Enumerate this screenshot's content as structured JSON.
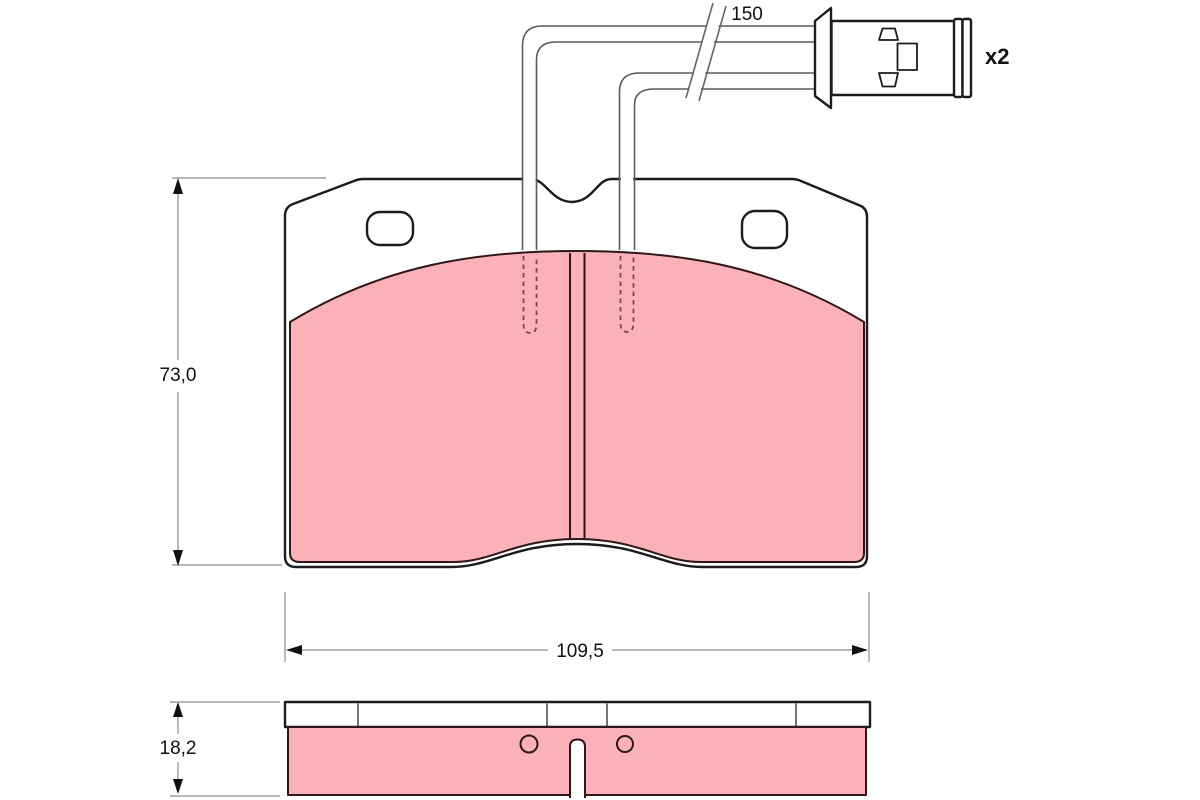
{
  "drawing": {
    "type": "brake-pad-technical-drawing",
    "dimensions": {
      "pad_height": "73,0",
      "pad_width": "109,5",
      "pad_thickness": "18,2",
      "sensor_wire_length": "150"
    },
    "annotations": {
      "quantity": "x2"
    },
    "colors": {
      "friction_material": "#FAB2B8",
      "outline": "#1C1C1C",
      "dimension_line": "#8C8C8C",
      "hidden_line": "#7A4545"
    }
  }
}
